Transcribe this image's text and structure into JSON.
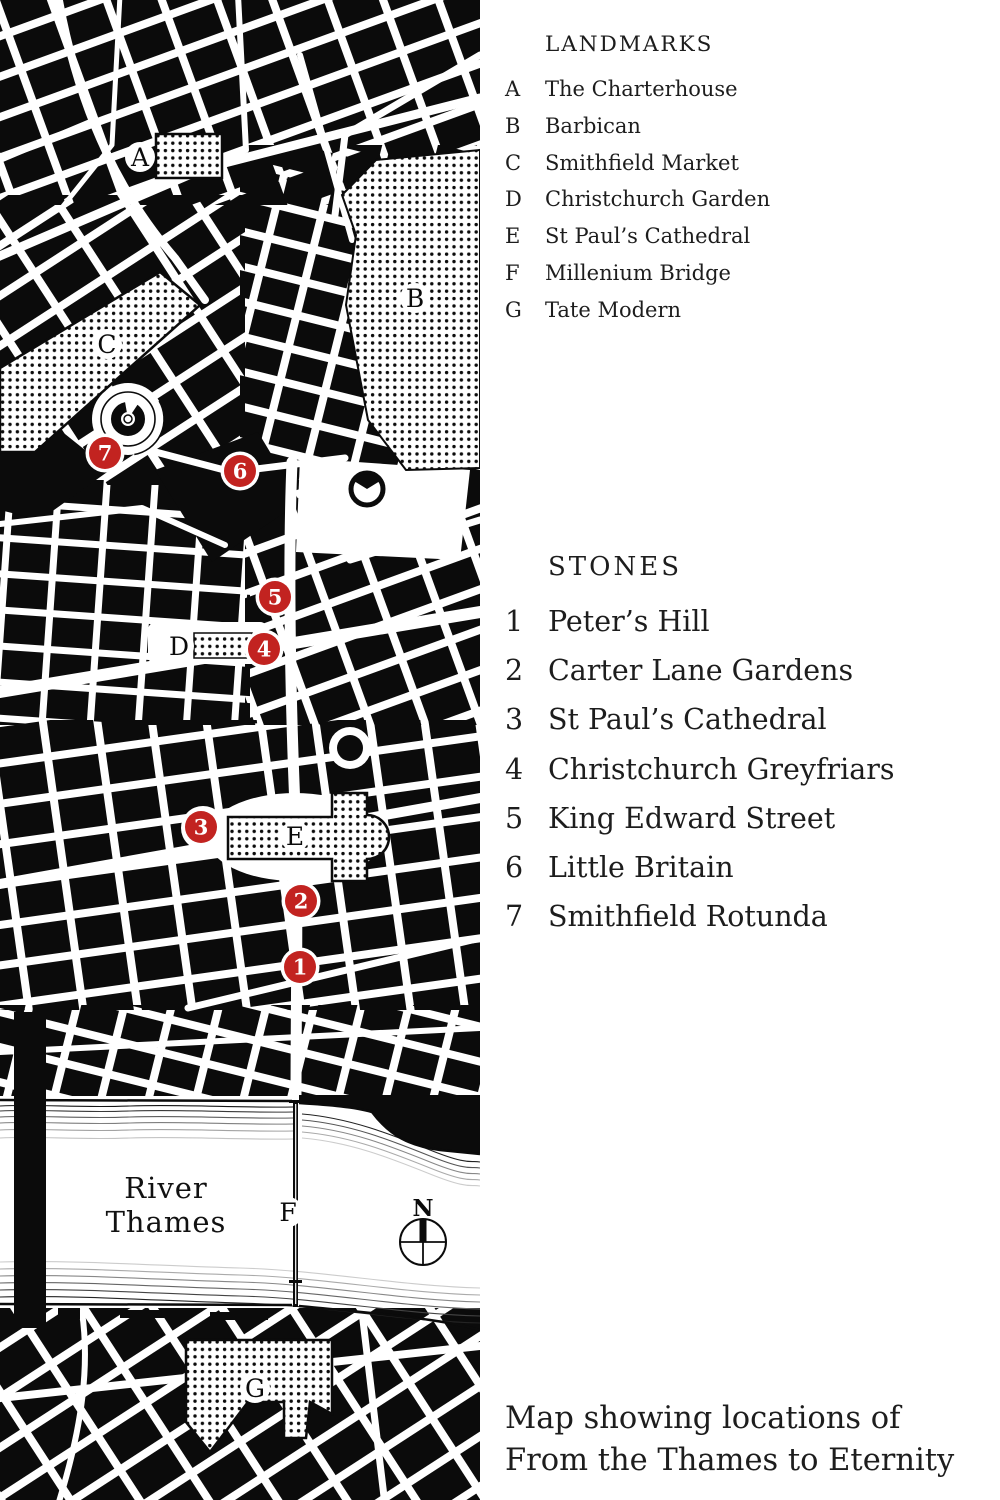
{
  "colors": {
    "ink": "#0b0b0b",
    "red": "#c22320",
    "paper": "#ffffff"
  },
  "landmarks": {
    "title": "LANDMARKS",
    "items": [
      {
        "key": "A",
        "label": "The Charterhouse"
      },
      {
        "key": "B",
        "label": "Barbican"
      },
      {
        "key": "C",
        "label": "Smithfield Market"
      },
      {
        "key": "D",
        "label": "Christchurch Garden"
      },
      {
        "key": "E",
        "label": "St Paul’s Cathedral"
      },
      {
        "key": "F",
        "label": "Millenium Bridge"
      },
      {
        "key": "G",
        "label": "Tate Modern"
      }
    ]
  },
  "stones": {
    "title": "STONES",
    "items": [
      {
        "key": "1",
        "label": "Peter’s Hill"
      },
      {
        "key": "2",
        "label": "Carter Lane Gardens"
      },
      {
        "key": "3",
        "label": "St Paul’s Cathedral"
      },
      {
        "key": "4",
        "label": "Christchurch Greyfriars"
      },
      {
        "key": "5",
        "label": "King Edward Street"
      },
      {
        "key": "6",
        "label": "Little Britain"
      },
      {
        "key": "7",
        "label": "Smithfield Rotunda"
      }
    ]
  },
  "caption": {
    "line1": "Map showing locations of",
    "line2": "From the Thames to Eternity"
  },
  "map": {
    "river_label_line1": "River",
    "river_label_line2": "Thames",
    "compass_label": "N",
    "letters": [
      {
        "id": "A",
        "x": 140,
        "y": 157
      },
      {
        "id": "B",
        "x": 415,
        "y": 298
      },
      {
        "id": "C",
        "x": 107,
        "y": 344
      },
      {
        "id": "D",
        "x": 179,
        "y": 646
      },
      {
        "id": "E",
        "x": 295,
        "y": 836
      },
      {
        "id": "F",
        "x": 288,
        "y": 1212
      },
      {
        "id": "G",
        "x": 255,
        "y": 1388
      }
    ],
    "markers": [
      {
        "n": "1",
        "x": 300,
        "y": 967
      },
      {
        "n": "2",
        "x": 301,
        "y": 901
      },
      {
        "n": "3",
        "x": 201,
        "y": 827
      },
      {
        "n": "4",
        "x": 264,
        "y": 649
      },
      {
        "n": "5",
        "x": 275,
        "y": 597
      },
      {
        "n": "6",
        "x": 240,
        "y": 471
      },
      {
        "n": "7",
        "x": 105,
        "y": 453
      }
    ]
  }
}
